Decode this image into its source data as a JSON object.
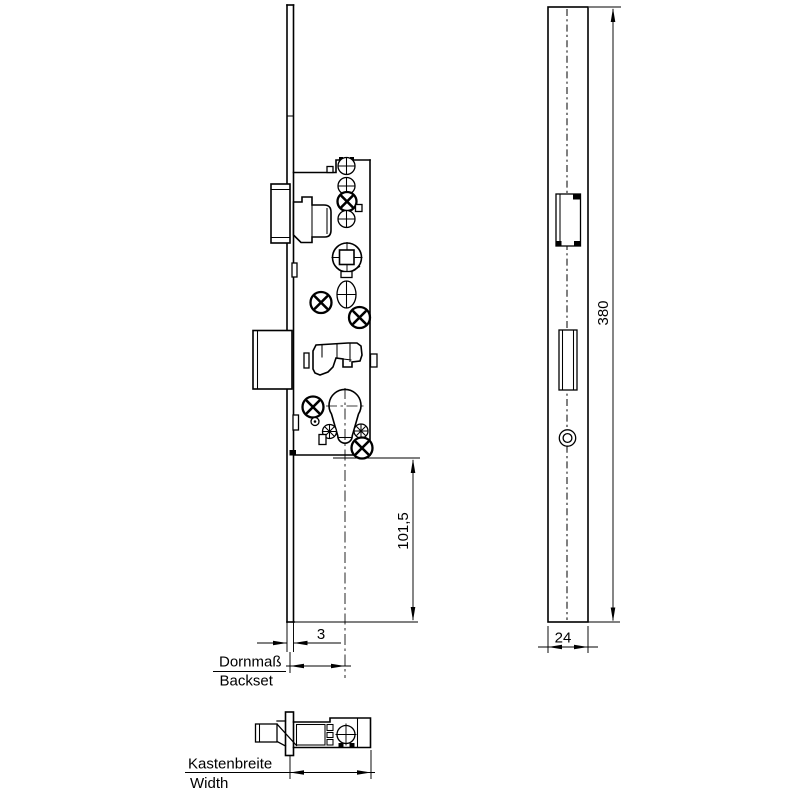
{
  "colors": {
    "background": "#ffffff",
    "line": "#000000"
  },
  "dimensions": {
    "faceplate_thickness": "3",
    "case_to_plate_end": "101,5",
    "faceplate_length": "380",
    "faceplate_width": "24"
  },
  "labels": {
    "backset_de": "Dornmaß",
    "backset_en": "Backset",
    "case_width_de": "Kastenbreite",
    "case_width_en": "Width"
  }
}
